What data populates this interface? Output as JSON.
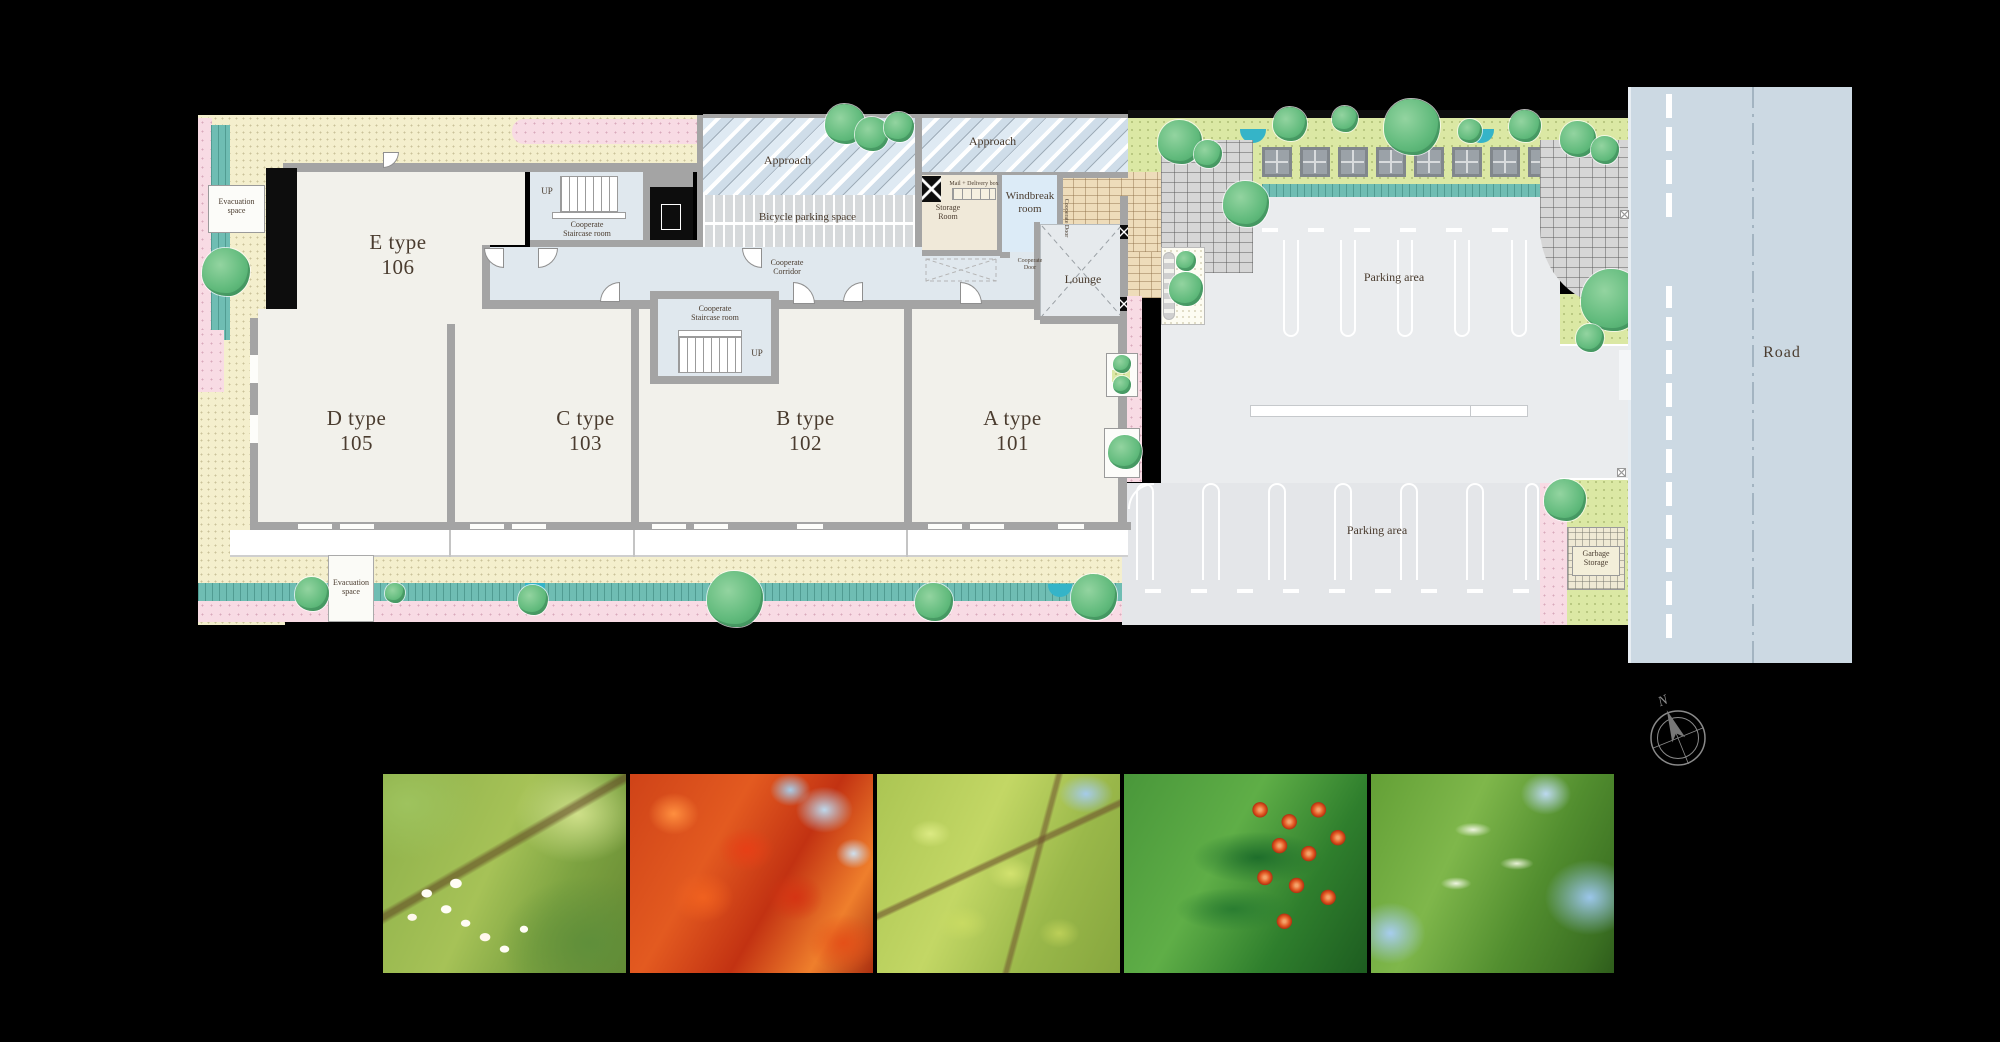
{
  "site_plan": {
    "units": {
      "e": {
        "type": "E type",
        "number": "106"
      },
      "d": {
        "type": "D type",
        "number": "105"
      },
      "c": {
        "type": "C type",
        "number": "103"
      },
      "b": {
        "type": "B type",
        "number": "102"
      },
      "a": {
        "type": "A type",
        "number": "101"
      }
    },
    "labels": {
      "evacuation_space": "Evacuation space",
      "up": "UP",
      "cooperate_staircase_room": "Cooperate Staircase room",
      "cooperate_corridor": "Cooperate Corridor",
      "cooperate_door": "Cooperate Door",
      "approach": "Approach",
      "bicycle_parking_space": "Bicycle parking space",
      "storage_room": "Storage Room",
      "mail_delivery_box": "Mail + Delivery box",
      "windbreak_room": "Windbreak room",
      "lounge": "Lounge",
      "parking_area": "Parking area",
      "garbage_storage": "Garbage Storage",
      "road": "Road"
    },
    "colors": {
      "background": "#000000",
      "gravel": "#f4efcd",
      "pink_planting": "#f8dbe4",
      "hedge_teal": "#6fbdb3",
      "pond_blue": "#35b4c8",
      "lawn_green": "#dbe8a4",
      "room_floor": "#f2f1eb",
      "corridor_blue": "#e0e8ee",
      "wall_gray": "#a4a4a4",
      "asphalt": "#eaecee",
      "road_blue_gray": "#ccd9e3",
      "brick_tan": "#eedcba",
      "brick_gray": "#d6d6d6",
      "tree_green": "#62bb7d",
      "label_brown": "#4a3c2f"
    }
  },
  "compass": {
    "north_label": "N"
  },
  "photos": [
    {
      "name": "white-styrax-flowers",
      "description": "white bell flowers on green branch"
    },
    {
      "name": "red-maple-leaves",
      "description": "red japanese maple leaves"
    },
    {
      "name": "fresh-green-branch",
      "description": "fresh green leaves on thin branches"
    },
    {
      "name": "red-berries",
      "description": "green leaves with round red berries"
    },
    {
      "name": "green-canopy",
      "description": "fresh green tree canopy against blue sky"
    }
  ]
}
